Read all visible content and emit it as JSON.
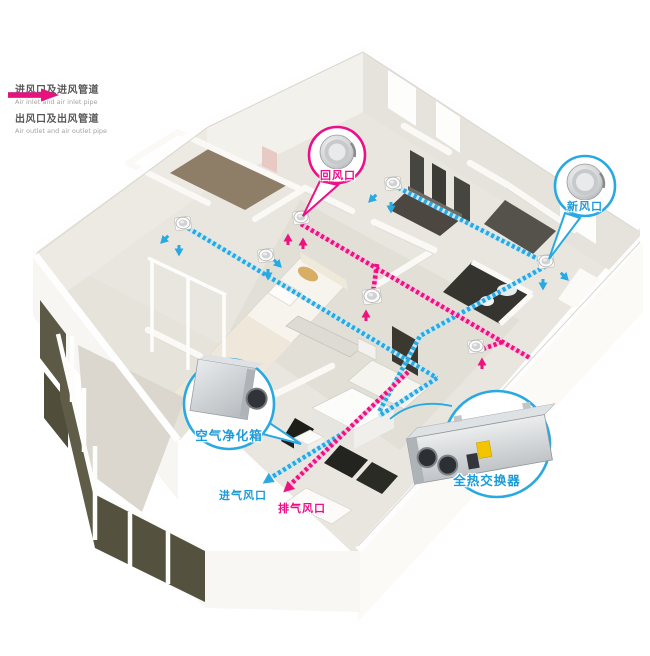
{
  "legend": {
    "items": [
      {
        "id": "air-inlet",
        "zh": "进风口及进风管道",
        "en": "Air inlet and air inlet pipe",
        "color": "#1f9ed9"
      },
      {
        "id": "air-outlet",
        "zh": "出风口及出风管道",
        "en": "Air outlet and air outlet pipe",
        "color": "#e8127d"
      }
    ]
  },
  "callouts": {
    "return_air": {
      "label": "回风口",
      "color": "#ec0f8a",
      "icon": "round-ceiling-diffuser"
    },
    "fresh_air": {
      "label": "新风口",
      "color": "#29a9e1",
      "icon": "round-ceiling-diffuser"
    },
    "air_purifier": {
      "label": "空气净化箱",
      "color": "#29a9e1",
      "icon": "purifier-box-device"
    },
    "heat_exchanger": {
      "label": "全热交换器",
      "color": "#29a9e1",
      "icon": "heat-exchanger-device"
    }
  },
  "floor_labels": {
    "intake": {
      "label": "进气风口",
      "color": "#29a9e1"
    },
    "exhaust": {
      "label": "排气风口",
      "color": "#ec0f8a"
    }
  },
  "scene": {
    "supply_vent_count": 4,
    "return_vent_count": 3,
    "pipe_style": "dashed",
    "view": "isometric-cutaway-apartment"
  },
  "icons": {
    "flow_arrow": "triangle-arrow",
    "supply_vent": "ceiling-diffuser",
    "return_vent": "ceiling-diffuser"
  },
  "colors": {
    "pipe_blue": "#29a9e1",
    "pipe_pink": "#ee1280",
    "wall": "#f6f4f0",
    "floor": "#e9e6df",
    "balcony_glass": "#5f5d48"
  }
}
